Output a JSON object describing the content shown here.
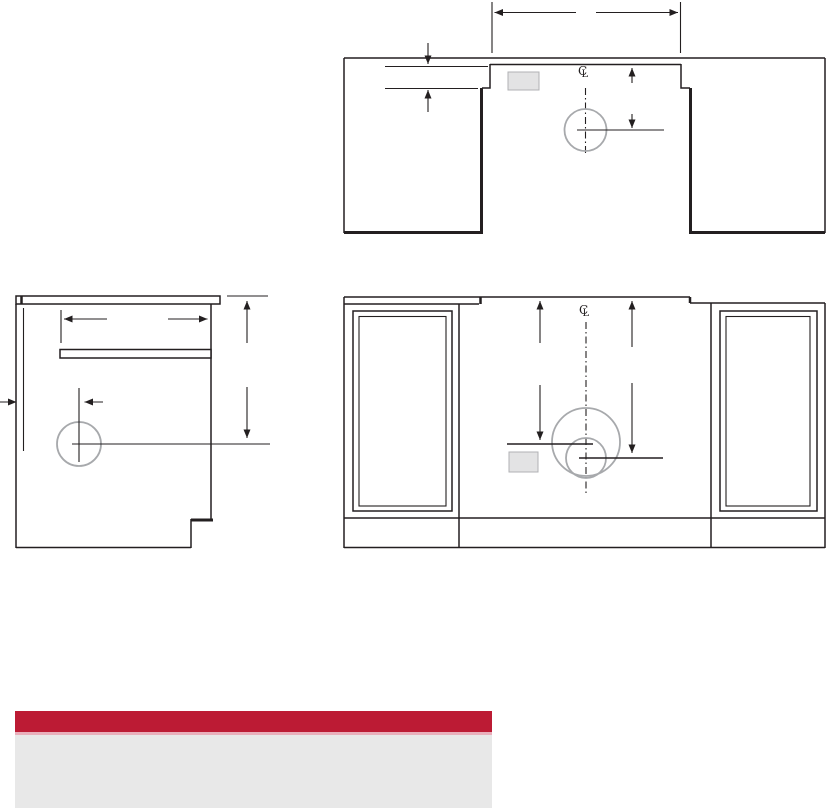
{
  "colors": {
    "page-bg": "#ffffff",
    "line-color": "#231f20",
    "gray-line": "#a7a9ac",
    "gray-fill": "#e3e3e4",
    "accent-red": "#bc1b34",
    "accent-red-light": "#e9afbb",
    "panel-gray": "#e8e8e8"
  },
  "symbols": {
    "centerline_c": "C",
    "centerline_l": "L"
  }
}
